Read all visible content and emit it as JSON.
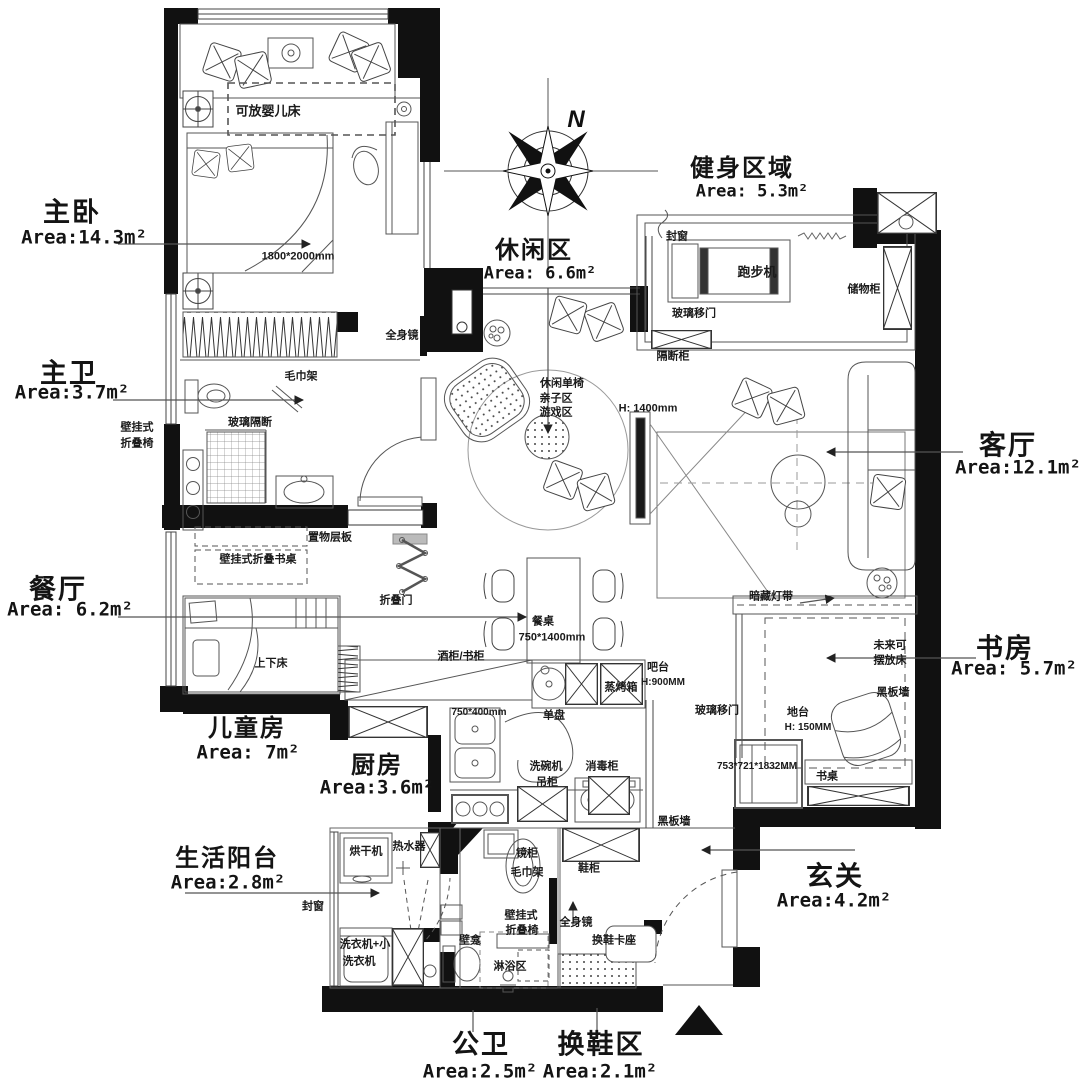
{
  "compass": {
    "north_label": "N"
  },
  "rooms": {
    "master": {
      "name": "主卧",
      "area": "Area:14.3m²"
    },
    "master_bath": {
      "name": "主卫",
      "area": "Area:3.7m²"
    },
    "dining": {
      "name": "餐厅",
      "area": "Area: 6.2m²"
    },
    "kids": {
      "name": "儿童房",
      "area": "Area: 7m²"
    },
    "kitchen": {
      "name": "厨房",
      "area": "Area:3.6m²"
    },
    "laundry": {
      "name": "生活阳台",
      "area": "Area:2.8m²"
    },
    "public_bath": {
      "name": "公卫",
      "area": "Area:2.5m²"
    },
    "shoe": {
      "name": "换鞋区",
      "area": "Area:2.1m²"
    },
    "entry": {
      "name": "玄关",
      "area": "Area:4.2m²"
    },
    "study": {
      "name": "书房",
      "area": "Area: 5.7m²"
    },
    "living": {
      "name": "客厅",
      "area": "Area:12.1m²"
    },
    "fitness": {
      "name": "健身区域",
      "area": "Area: 5.3m²"
    },
    "leisure": {
      "name": "休闲区",
      "area": "Area: 6.6m²"
    }
  },
  "ann": {
    "a1": "1800*2000mm",
    "a2": "可放婴儿床",
    "a3": "毛巾架",
    "a4": "玻璃隔断",
    "a5": "壁挂式",
    "a6": "折叠椅",
    "a7": "置物层板",
    "a8": "壁挂式折叠书桌",
    "a9": "折叠门",
    "a10": "上下床",
    "a11": "全身镜",
    "a12": "餐桌",
    "a13": "750*1400mm",
    "a14": "酒柜/书柜",
    "a15": "吧台",
    "a16": "H:900MM",
    "a17": "蒸烤箱",
    "a18": "单盘",
    "a19": "750*400mm",
    "a20": "洗碗机",
    "a21": "消毒柜",
    "a22": "吊柜",
    "a23": "烘干机",
    "a24": "热水器",
    "a25": "洗衣机+小",
    "a26": "洗衣机",
    "a27": "封窗",
    "a28": "壁龛",
    "a29": "淋浴区",
    "a30": "壁挂式",
    "a31": "折叠椅",
    "a32": "毛巾架",
    "a33": "镜柜",
    "a34": "全身镜",
    "a35": "换鞋卡座",
    "a36": "鞋柜",
    "a37": "黑板墙",
    "a38": "跑步机",
    "a39": "封窗",
    "a40": "玻璃移门",
    "a41": "储物柜",
    "a42": "隔断柜",
    "a43": "休闲单椅",
    "a44": "亲子区",
    "a45": "游戏区",
    "a46": "H: 1400mm",
    "a47": "暗藏灯带",
    "a48": "未来可",
    "a49": "摆放床",
    "a50": "黑板墙",
    "a51": "地台",
    "a52": "H: 150MM",
    "a53": "玻璃移门",
    "a54": "753*721*1832MM",
    "a55": "书桌"
  }
}
